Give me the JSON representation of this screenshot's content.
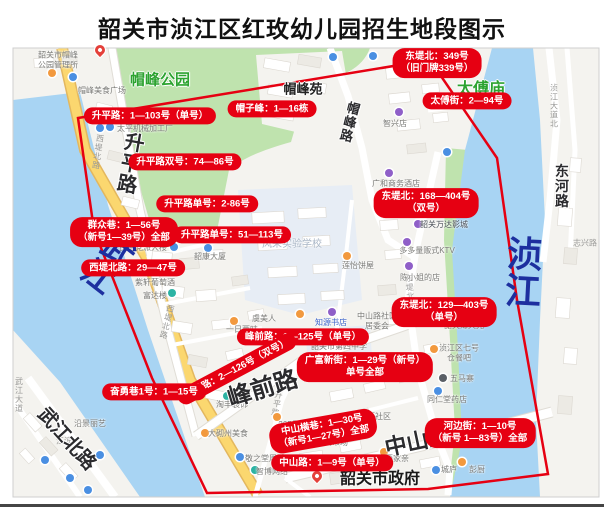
{
  "title": "韶关市浈江区红玫幼儿园招生地段图示",
  "colors": {
    "red": "#e60012",
    "water": "#a8d4f3",
    "park": "#bfe3ae",
    "park_label": "#2ca330",
    "river_label": "#1d2f9f",
    "land": "#f4f3ef",
    "road_yellow": "#fbd76f",
    "campus": "#e7edf5"
  },
  "map": {
    "red_labels": [
      {
        "id": "dongdibei-349",
        "x": 437,
        "y": 63,
        "rot": 0,
        "lines": [
          "东堤北：349号",
          "（旧门牌339号）"
        ]
      },
      {
        "id": "taifu-jie",
        "x": 467,
        "y": 101,
        "rot": 0,
        "lines": [
          "太傅街：2—94号"
        ]
      },
      {
        "id": "maozifeng",
        "x": 272,
        "y": 109,
        "rot": 0,
        "lines": [
          "帽子峰：1—16栋"
        ]
      },
      {
        "id": "shengping-1-103",
        "x": 150,
        "y": 116,
        "rot": 0,
        "lines": [
          "升平路：1—103号（单号）"
        ]
      },
      {
        "id": "shengping-shuang-74-86",
        "x": 185,
        "y": 162,
        "rot": 0,
        "lines": [
          "升平路双号：74—86号"
        ]
      },
      {
        "id": "shengping-dan-2-86",
        "x": 207,
        "y": 204,
        "rot": 0,
        "lines": [
          "升平路单号：2-86号"
        ]
      },
      {
        "id": "shengping-dan-51-113",
        "x": 232,
        "y": 235,
        "rot": 0,
        "lines": [
          "升平路单号：51—113号"
        ]
      },
      {
        "id": "qunzhong-xiang",
        "x": 124,
        "y": 232,
        "rot": 0,
        "lines": [
          "群众巷：1—56号",
          "（新号1—39号）全部"
        ]
      },
      {
        "id": "xidibeilu-29-47",
        "x": 133,
        "y": 268,
        "rot": 0,
        "lines": [
          "西堤北路：29—47号"
        ]
      },
      {
        "id": "fengqian-dan",
        "x": 303,
        "y": 337,
        "rot": 0,
        "lines": [
          "峰前路：1—125号（单号）"
        ]
      },
      {
        "id": "fengqian-shuang",
        "x": 237,
        "y": 369,
        "rot": -28,
        "lines": [
          "峰前路：2—126号（双号）"
        ]
      },
      {
        "id": "fenyong-xiang",
        "x": 154,
        "y": 392,
        "rot": 0,
        "lines": [
          "奋勇巷1号：1—15号"
        ]
      },
      {
        "id": "dongdibei-168-404",
        "x": 426,
        "y": 203,
        "rot": 0,
        "lines": [
          "东堤北：168—404号",
          "（双号）"
        ]
      },
      {
        "id": "dongdibei-129-403",
        "x": 444,
        "y": 312,
        "rot": 0,
        "lines": [
          "东堤北：129—403号",
          "（单号）"
        ]
      },
      {
        "id": "guangfu-xinjie",
        "x": 365,
        "y": 367,
        "rot": 0,
        "lines": [
          "广富新街：1—29号（新号）",
          "单号全部"
        ]
      },
      {
        "id": "zhongshan-hengxiang",
        "x": 323,
        "y": 431,
        "rot": -10,
        "lines": [
          "中山横巷：1—30号",
          "（新号1—27号）全部"
        ]
      },
      {
        "id": "zhongshan-lu-1-9",
        "x": 332,
        "y": 463,
        "rot": 0,
        "lines": [
          "中山路：1—9号（单号）"
        ]
      },
      {
        "id": "hebian-jie",
        "x": 480,
        "y": 433,
        "rot": 0,
        "lines": [
          "河边街：1—10号",
          "（新号 1—83号）全部"
        ]
      }
    ],
    "area_labels": [
      {
        "text": "帽峰公园",
        "x": 160,
        "y": 79,
        "size": 15,
        "color": "green"
      },
      {
        "text": "太傅庙",
        "x": 481,
        "y": 87,
        "size": 16,
        "color": "green"
      },
      {
        "text": "帽峰苑",
        "x": 303,
        "y": 88,
        "size": 13,
        "color": "black"
      }
    ],
    "street_labels": [
      {
        "text": "升平路",
        "x": 129,
        "y": 163,
        "size": 20,
        "rot": 10,
        "vertical": true
      },
      {
        "text": "帽峰路",
        "x": 349,
        "y": 122,
        "size": 13,
        "rot": 14,
        "vertical": true
      },
      {
        "text": "峰前路",
        "x": 262,
        "y": 386,
        "size": 24,
        "rot": -17
      },
      {
        "text": "中山路",
        "x": 417,
        "y": 440,
        "size": 22,
        "rot": -12
      },
      {
        "text": "武江北路",
        "x": 68,
        "y": 438,
        "size": 19,
        "rot": 48
      },
      {
        "text": "东河路",
        "x": 562,
        "y": 186,
        "size": 14,
        "rot": 0,
        "vertical": true
      }
    ],
    "river_labels": [
      {
        "text": "武江",
        "x": 107,
        "y": 262,
        "size": 32,
        "rot": 38
      },
      {
        "text": "浈江",
        "x": 521,
        "y": 272,
        "size": 36,
        "rot": 3
      }
    ],
    "minor_road_labels": [
      {
        "text": "西堤北路",
        "x": 98,
        "y": 152,
        "vertical": true,
        "rot": 8
      },
      {
        "text": "西堤北路",
        "x": 167,
        "y": 322,
        "vertical": true,
        "rot": 14
      },
      {
        "text": "升平路",
        "x": 277,
        "y": 404,
        "vertical": true,
        "rot": 10
      },
      {
        "text": "东堤北路",
        "x": 410,
        "y": 292,
        "vertical": true,
        "rot": -4
      },
      {
        "text": "浈江大道北",
        "x": 554,
        "y": 106,
        "vertical": true,
        "rot": 0
      },
      {
        "text": "志兴路",
        "x": 585,
        "y": 243,
        "rot": 0
      },
      {
        "text": "江滨",
        "x": 64,
        "y": 441,
        "rot": 0
      },
      {
        "text": "武江大道",
        "x": 19,
        "y": 395,
        "vertical": true,
        "rot": 0
      }
    ],
    "poi_labels": [
      {
        "lines": [
          "韶关市帽峰",
          "公园管理所"
        ],
        "x": 58,
        "y": 60
      },
      {
        "lines": [
          "帽峰美食广场"
        ],
        "x": 102,
        "y": 91
      },
      {
        "lines": [
          "太平机械加工厂"
        ],
        "x": 145,
        "y": 129
      },
      {
        "lines": [
          "民主党派大楼"
        ],
        "x": 143,
        "y": 248
      },
      {
        "lines": [
          "韶康大厦"
        ],
        "x": 210,
        "y": 257
      },
      {
        "lines": [
          "紫轩葡萄酒"
        ],
        "x": 155,
        "y": 283
      },
      {
        "lines": [
          "富达楼"
        ],
        "x": 155,
        "y": 296
      },
      {
        "lines": [
          "一日两味"
        ],
        "x": 242,
        "y": 330
      },
      {
        "lines": [
          "风采实验学校"
        ],
        "x": 292,
        "y": 245,
        "size": 10,
        "color": "#a9b6c6"
      },
      {
        "lines": [
          "虞美人"
        ],
        "x": 264,
        "y": 319
      },
      {
        "lines": [
          "知源书店"
        ],
        "x": 331,
        "y": 323,
        "color": "#3a62c9"
      },
      {
        "lines": [
          "中山路社区",
          "居委会"
        ],
        "x": 377,
        "y": 321
      },
      {
        "lines": [
          "韶关市第四中学"
        ],
        "x": 339,
        "y": 347
      },
      {
        "lines": [
          "广和商务酒店"
        ],
        "x": 396,
        "y": 184
      },
      {
        "lines": [
          "韶关万达影城"
        ],
        "x": 444,
        "y": 225,
        "color": "#4a4f57"
      },
      {
        "lines": [
          "多多量贩式KTV"
        ],
        "x": 427,
        "y": 251
      },
      {
        "lines": [
          "陈小姐的店"
        ],
        "x": 420,
        "y": 278
      },
      {
        "lines": [
          "莲怡饼屋"
        ],
        "x": 358,
        "y": 266
      },
      {
        "lines": [
          "智兴店"
        ],
        "x": 395,
        "y": 124
      },
      {
        "lines": [
          "韶关薄天光"
        ],
        "x": 464,
        "y": 326
      },
      {
        "lines": [
          "浈江区七号",
          "仓餐吧"
        ],
        "x": 459,
        "y": 353
      },
      {
        "lines": [
          "五马寨"
        ],
        "x": 462,
        "y": 379
      },
      {
        "lines": [
          "同仁堂药店"
        ],
        "x": 447,
        "y": 400
      },
      {
        "lines": [
          "峰前街社区"
        ],
        "x": 371,
        "y": 417
      },
      {
        "lines": [
          "中山市场"
        ],
        "x": 332,
        "y": 443
      },
      {
        "lines": [
          "两家亲"
        ],
        "x": 397,
        "y": 459
      },
      {
        "lines": [
          "城庐"
        ],
        "x": 449,
        "y": 470
      },
      {
        "lines": [
          "彭厨"
        ],
        "x": 477,
        "y": 470
      },
      {
        "lines": [
          "敬之堂周诚"
        ],
        "x": 265,
        "y": 459
      },
      {
        "lines": [
          "智博网络"
        ],
        "x": 272,
        "y": 472
      },
      {
        "lines": [
          "365便利"
        ],
        "x": 293,
        "y": 425
      },
      {
        "lines": [
          "淘丰装饰"
        ],
        "x": 232,
        "y": 405
      },
      {
        "lines": [
          "大砌州美食"
        ],
        "x": 228,
        "y": 434
      },
      {
        "lines": [
          "沿景丽艺"
        ],
        "x": 90,
        "y": 424
      },
      {
        "lines": [
          "韶关市政府"
        ],
        "x": 380,
        "y": 479,
        "size": 16,
        "bold": true,
        "color": "#1a1a1a"
      }
    ],
    "poi_icons": [
      {
        "shape": "pin",
        "color": "#e4403a",
        "x": 100,
        "y": 52
      },
      {
        "shape": "pin",
        "color": "#e4403a",
        "x": 317,
        "y": 478
      },
      {
        "shape": "dot",
        "color": "#f2993e",
        "x": 52,
        "y": 73
      },
      {
        "shape": "dot",
        "color": "#f2993e",
        "x": 234,
        "y": 321
      },
      {
        "shape": "dot",
        "color": "#f2993e",
        "x": 300,
        "y": 314
      },
      {
        "shape": "dot",
        "color": "#f2993e",
        "x": 347,
        "y": 256
      },
      {
        "shape": "dot",
        "color": "#f2993e",
        "x": 448,
        "y": 324
      },
      {
        "shape": "dot",
        "color": "#f2993e",
        "x": 434,
        "y": 349
      },
      {
        "shape": "dot",
        "color": "#f2993e",
        "x": 462,
        "y": 462
      },
      {
        "shape": "dot",
        "color": "#f2993e",
        "x": 205,
        "y": 433
      },
      {
        "shape": "dot",
        "color": "#f2993e",
        "x": 277,
        "y": 417
      },
      {
        "shape": "dot",
        "color": "#f2993e",
        "x": 384,
        "y": 452
      },
      {
        "shape": "dot",
        "color": "#8f5fc8",
        "x": 389,
        "y": 173
      },
      {
        "shape": "dot",
        "color": "#8f5fc8",
        "x": 332,
        "y": 312
      },
      {
        "shape": "dot",
        "color": "#8f5fc8",
        "x": 407,
        "y": 242
      },
      {
        "shape": "dot",
        "color": "#8f5fc8",
        "x": 409,
        "y": 266
      },
      {
        "shape": "dot",
        "color": "#8f5fc8",
        "x": 399,
        "y": 112
      },
      {
        "shape": "dot",
        "color": "#8f5fc8",
        "x": 418,
        "y": 224
      },
      {
        "shape": "dot",
        "color": "#4a8fe2",
        "x": 110,
        "y": 127
      },
      {
        "shape": "dot",
        "color": "#4a8fe2",
        "x": 174,
        "y": 247
      },
      {
        "shape": "dot",
        "color": "#4a8fe2",
        "x": 208,
        "y": 248
      },
      {
        "shape": "dot",
        "color": "#4a8fe2",
        "x": 438,
        "y": 391
      },
      {
        "shape": "dot",
        "color": "#4a8fe2",
        "x": 436,
        "y": 470
      },
      {
        "shape": "dot",
        "color": "#4a8fe2",
        "x": 240,
        "y": 457
      },
      {
        "shape": "dot",
        "color": "#4a8fe2",
        "x": 333,
        "y": 57
      },
      {
        "shape": "dot",
        "color": "#4a8fe2",
        "x": 373,
        "y": 56
      },
      {
        "shape": "dot",
        "color": "#4a8fe2",
        "x": 447,
        "y": 152
      },
      {
        "shape": "dot",
        "color": "#4a8fe2",
        "x": 73,
        "y": 77
      },
      {
        "shape": "dot",
        "color": "#4a8fe2",
        "x": 100,
        "y": 128
      },
      {
        "shape": "dot",
        "color": "#4a8fe2",
        "x": 45,
        "y": 460
      },
      {
        "shape": "dot",
        "color": "#4a8fe2",
        "x": 70,
        "y": 478
      },
      {
        "shape": "dot",
        "color": "#4a8fe2",
        "x": 100,
        "y": 455
      },
      {
        "shape": "dot",
        "color": "#4a8fe2",
        "x": 88,
        "y": 490
      },
      {
        "shape": "dot",
        "color": "#2bb3a3",
        "x": 172,
        "y": 293
      },
      {
        "shape": "dot",
        "color": "#2bb3a3",
        "x": 255,
        "y": 470
      },
      {
        "shape": "dot",
        "color": "#2bb3a3",
        "x": 227,
        "y": 396
      },
      {
        "shape": "dot",
        "color": "#5a5f66",
        "x": 443,
        "y": 378
      }
    ]
  }
}
